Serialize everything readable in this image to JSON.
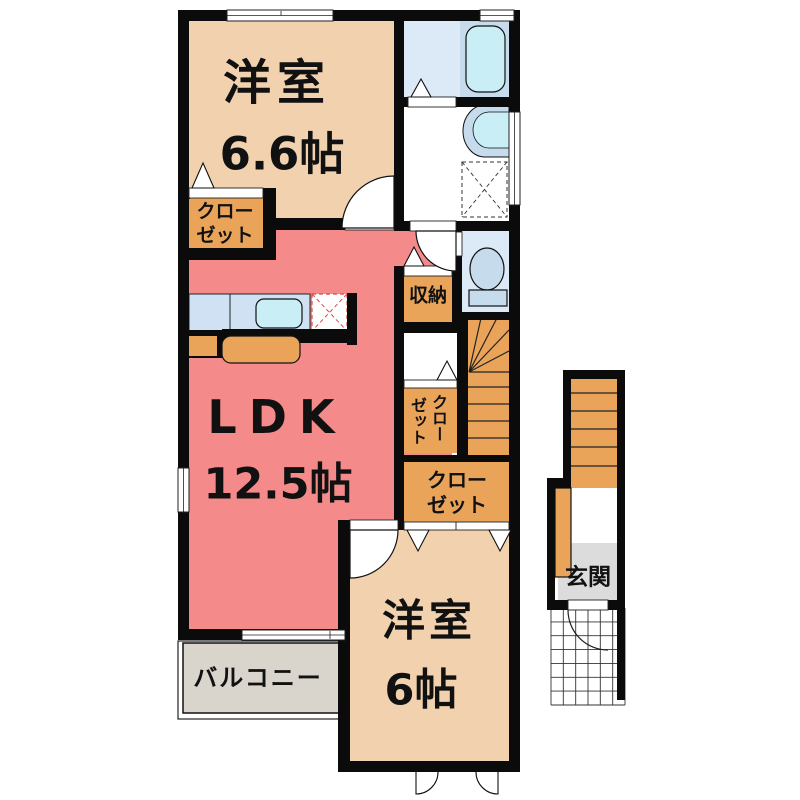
{
  "plan_title": "2F apartment floor plan",
  "colors": {
    "wall": "#0b0b0b",
    "room_tan": "#f2d2ae",
    "ldk_pink": "#f58a8a",
    "closet_orange": "#eaa45a",
    "bath_floor_blue": "#dce9f6",
    "fixture_blue": "#c6dbec",
    "water_cyan": "#c9eef6",
    "counter_blue": "#cfe1f2",
    "balcony_gray": "#d9d5cd",
    "genkan_gray": "#dcdcdc",
    "cooktop_red": "#e04545",
    "line_dark": "#222222"
  },
  "rooms": {
    "bedroom1": {
      "name": "洋室",
      "size": "6.6帖"
    },
    "ldk": {
      "name": "LDK",
      "size": "12.5帖"
    },
    "bedroom2": {
      "name": "洋室",
      "size": "6帖"
    },
    "closet1": {
      "line1": "クロー",
      "line2": "ゼット"
    },
    "storage": {
      "label": "収納"
    },
    "closet2": {
      "col_right": "クロー",
      "col_left": "ゼット"
    },
    "closet3": {
      "line1": "クロー",
      "line2": "ゼット"
    },
    "balcony": {
      "label": "バルコニー"
    },
    "entrance": {
      "label": "玄関"
    }
  },
  "fixtures": [
    "bathtub",
    "washbasin",
    "washing-machine-pan",
    "toilet",
    "kitchen-counter",
    "kitchen-sink",
    "cooktop",
    "kitchen-island",
    "staircase-indoor",
    "staircase-entrance",
    "porch-tiles"
  ]
}
